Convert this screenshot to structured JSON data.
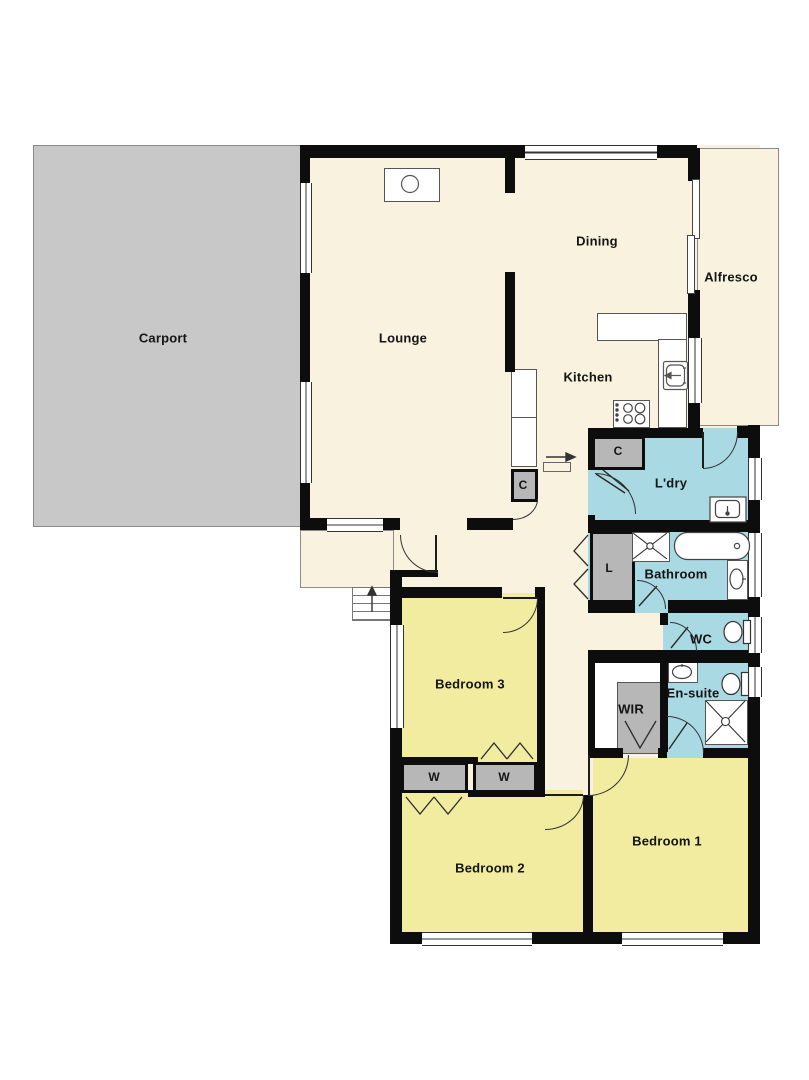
{
  "rooms": {
    "carport": {
      "label": "Carport"
    },
    "lounge": {
      "label": "Lounge"
    },
    "dining": {
      "label": "Dining"
    },
    "alfresco": {
      "label": "Alfresco"
    },
    "kitchen": {
      "label": "Kitchen"
    },
    "laundry": {
      "label": "L'dry"
    },
    "bathroom": {
      "label": "Bathroom"
    },
    "wc": {
      "label": "WC"
    },
    "ensuite": {
      "label": "En-suite"
    },
    "wir": {
      "label": "WIR"
    },
    "bedroom1": {
      "label": "Bedroom 1"
    },
    "bedroom2": {
      "label": "Bedroom 2"
    },
    "bedroom3": {
      "label": "Bedroom 3"
    }
  },
  "closets": {
    "entry_cupboard": {
      "label": "C"
    },
    "laundry_cupboard": {
      "label": "C"
    },
    "linen": {
      "label": "L"
    },
    "wardrobe_left": {
      "label": "W"
    },
    "wardrobe_right": {
      "label": "W"
    }
  },
  "colors": {
    "wall": "#0d0d0d",
    "living_floor": "#f8f2de",
    "bedroom_floor": "#f1ec9f",
    "wet_area_floor": "#a9d9e2",
    "closet_fill": "#b7b7b7",
    "carport_fill": "#c8c8c8",
    "outline": "#8a8a8a",
    "background": "#ffffff"
  }
}
